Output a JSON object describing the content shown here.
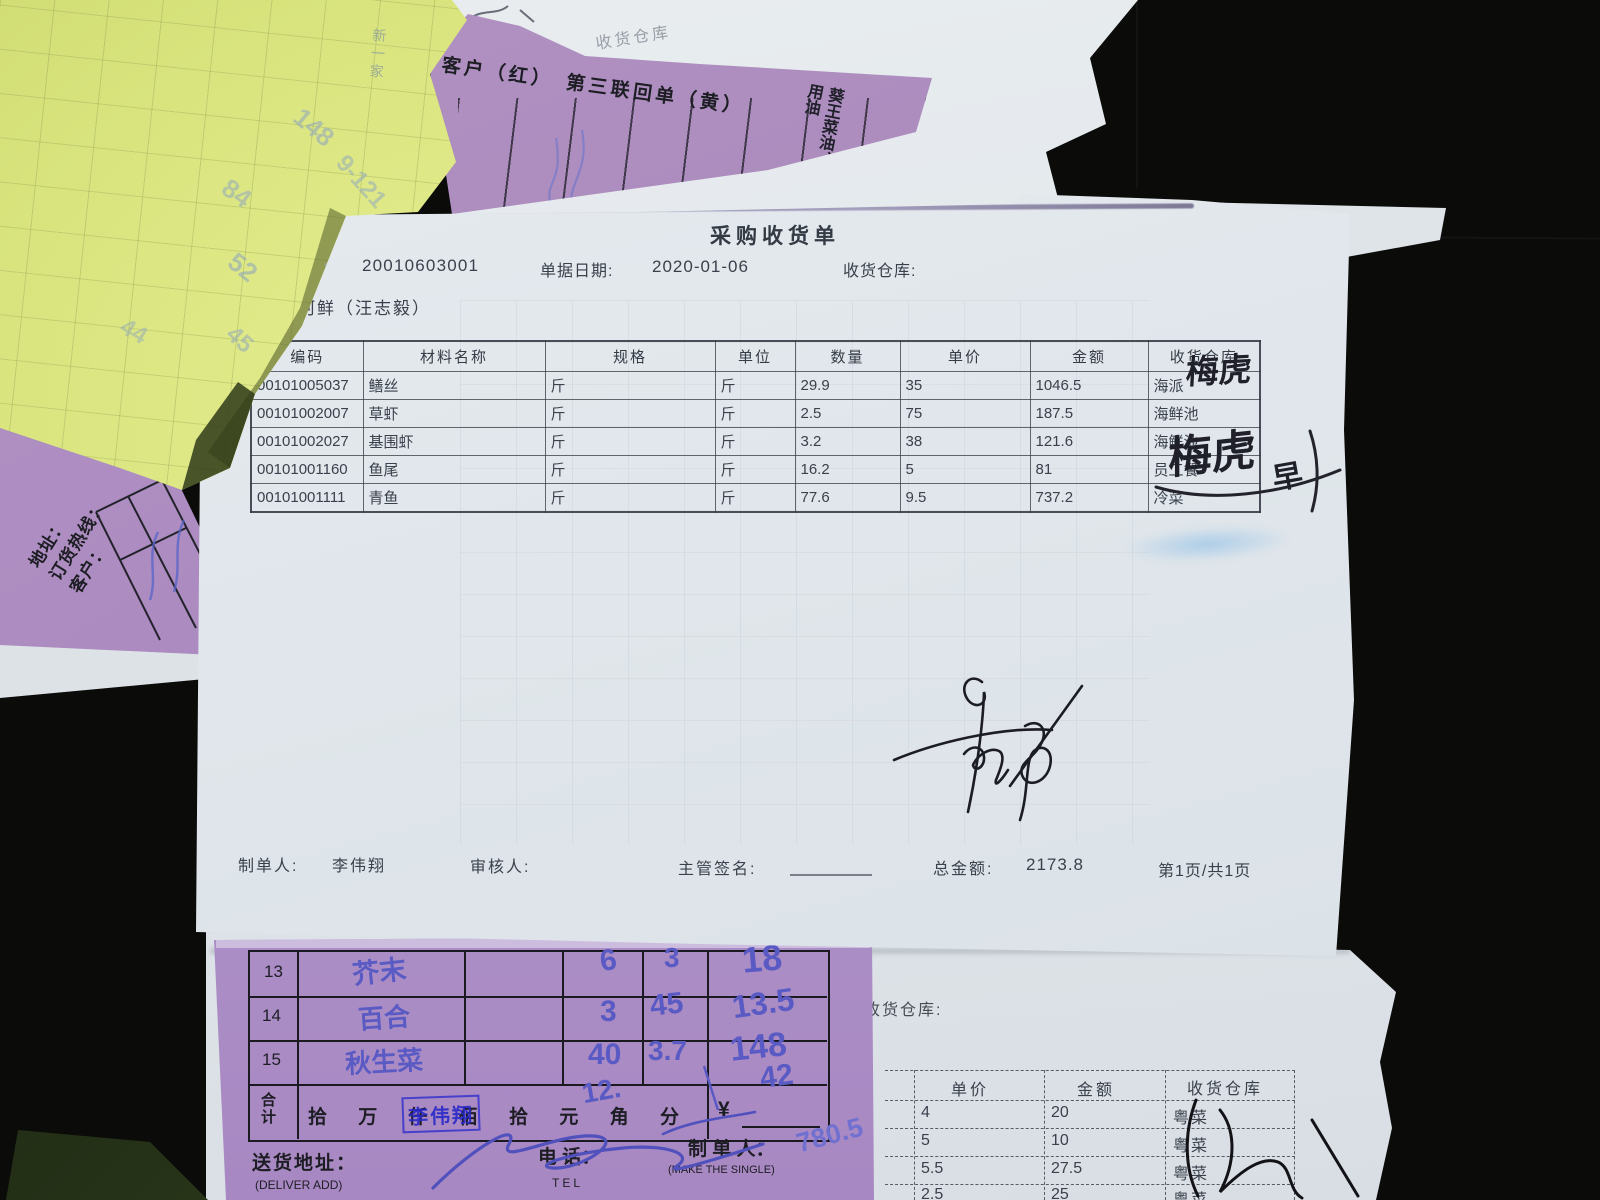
{
  "top_purple_doc": {
    "copy_line": "客户（红）　第三联回单（黄）",
    "vertical_note_right": "葵王菜油、",
    "vertical_note_left": "种食用油",
    "behind_sheet_label": "收货仓库"
  },
  "left_purple_doc": {
    "address_label": "地址：",
    "hotline_label": "订货热线：",
    "customer_label": "客户："
  },
  "yellow_note": {
    "corner_mark": "新一家",
    "faint_marks": [
      "148",
      "84",
      "9-121",
      "52",
      "181",
      "44",
      "45"
    ]
  },
  "main_doc": {
    "title": "采购收货单",
    "doc_no": "20010603001",
    "date_label": "单据日期:",
    "date": "2020-01-06",
    "warehouse_label": "收货仓库:",
    "supplier": "河鲜（汪志毅）",
    "table": {
      "headers": [
        "编码",
        "材料名称",
        "规格",
        "单位",
        "数量",
        "单价",
        "金额",
        "收货仓库"
      ],
      "rows": [
        [
          "00101005037",
          "鳝丝",
          "斤",
          "斤",
          "29.9",
          "35",
          "1046.5",
          "海派"
        ],
        [
          "00101002007",
          "草虾",
          "斤",
          "斤",
          "2.5",
          "75",
          "187.5",
          "海鲜池"
        ],
        [
          "00101002027",
          "基围虾",
          "斤",
          "斤",
          "3.2",
          "38",
          "121.6",
          "海鲜池"
        ],
        [
          "00101001160",
          "鱼尾",
          "斤",
          "斤",
          "16.2",
          "5",
          "81",
          "员工餐"
        ],
        [
          "00101001111",
          "青鱼",
          "斤",
          "斤",
          "77.6",
          "9.5",
          "737.2",
          "冷菜"
        ]
      ]
    },
    "handwriting": {
      "note_row1": "梅虎",
      "note_row4": "梅虎",
      "note_extra": "早"
    },
    "footer": {
      "maker_label": "制单人:",
      "maker": "李伟翔",
      "checker_label": "审核人:",
      "sign_label": "主管签名:",
      "total_label": "总金额:",
      "total": "2173.8",
      "page": "第1页/共1页"
    }
  },
  "bottom_purple_doc": {
    "rows": [
      {
        "no": "13",
        "name": "芥末",
        "qty": "6",
        "price": "3",
        "amount": "18"
      },
      {
        "no": "14",
        "name": "百合",
        "qty": "3",
        "price": "45",
        "amount": "13.5"
      },
      {
        "no": "15",
        "name": "秋生菜",
        "qty": "40",
        "price": "3.7",
        "amount": "148"
      }
    ],
    "total_label": "合计",
    "amount_scale": "拾 万 仟 佰 拾 元 角 分",
    "currency_symbol": "¥",
    "hand_total": "42",
    "hand_mid": "12.",
    "hand_subtotal": "780.5",
    "stamp": "李伟翔",
    "address_label": "送货地址：",
    "address_sub": "(DELIVER ADD)",
    "tel_label": "电 话：",
    "tel_sub": "TEL",
    "maker_label": "制 单 人：",
    "maker_sub": "(MAKE THE SINGLE)"
  },
  "bottom_right_doc": {
    "warehouse_label": "收货仓库:",
    "table": {
      "headers": [
        "单价",
        "金额",
        "收货仓库"
      ],
      "rows": [
        [
          "4",
          "20",
          "粤菜"
        ],
        [
          "5",
          "10",
          "粤菜"
        ],
        [
          "5.5",
          "27.5",
          "粤菜"
        ],
        [
          "2.5",
          "25",
          "粤菜"
        ]
      ]
    }
  }
}
